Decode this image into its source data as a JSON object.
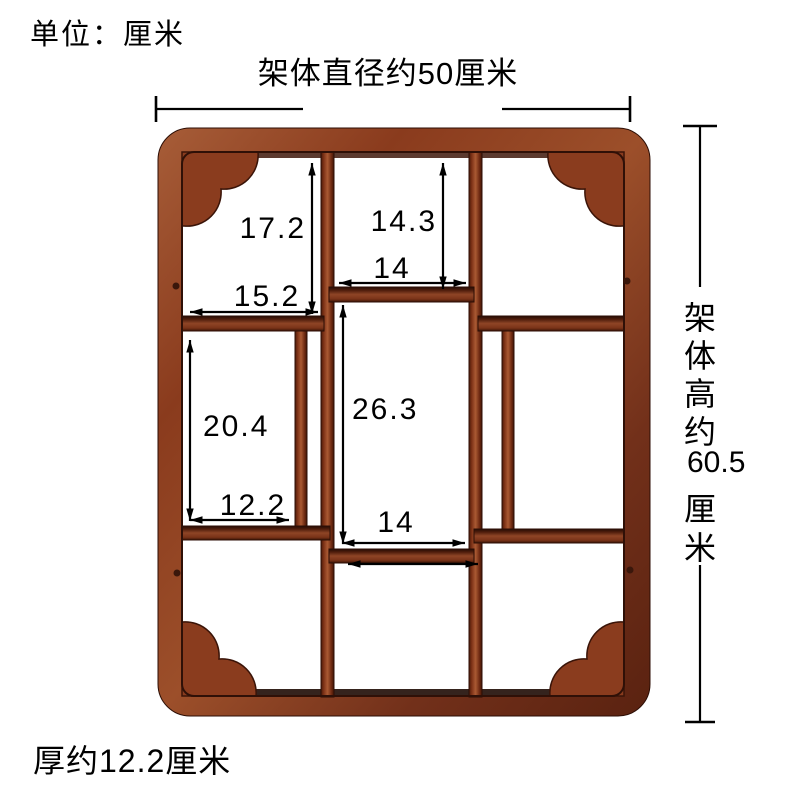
{
  "diagram": {
    "subject": "wooden-curio-wall-shelf-dimension-diagram",
    "background": "#ffffff",
    "labels": {
      "unit_note": "单位：厘米",
      "width_note": "架体直径约50厘米",
      "thickness_note": "厚约12.2厘米",
      "height_note": {
        "full": "架体高约60.5厘米",
        "segments": [
          "架",
          "体",
          "高",
          "约",
          "60.5",
          "厘",
          "米"
        ]
      }
    },
    "measurements": {
      "top_left_compartment_height": "17.2",
      "top_middle_compartment_height": "14.3",
      "top_middle_compartment_width": "14",
      "top_left_compartment_width": "15.2",
      "mid_left_compartment_height": "20.4",
      "center_compartment_height": "26.3",
      "lower_left_compartment_width": "12.2",
      "lower_middle_compartment_width": "14"
    },
    "colors": {
      "wood_light": "#aa5a33",
      "wood_mid": "#8a3b1d",
      "wood_dark": "#3c1507",
      "wood_shadow": "#1f0b04",
      "annotation_line": "#000000",
      "background": "#ffffff"
    }
  }
}
